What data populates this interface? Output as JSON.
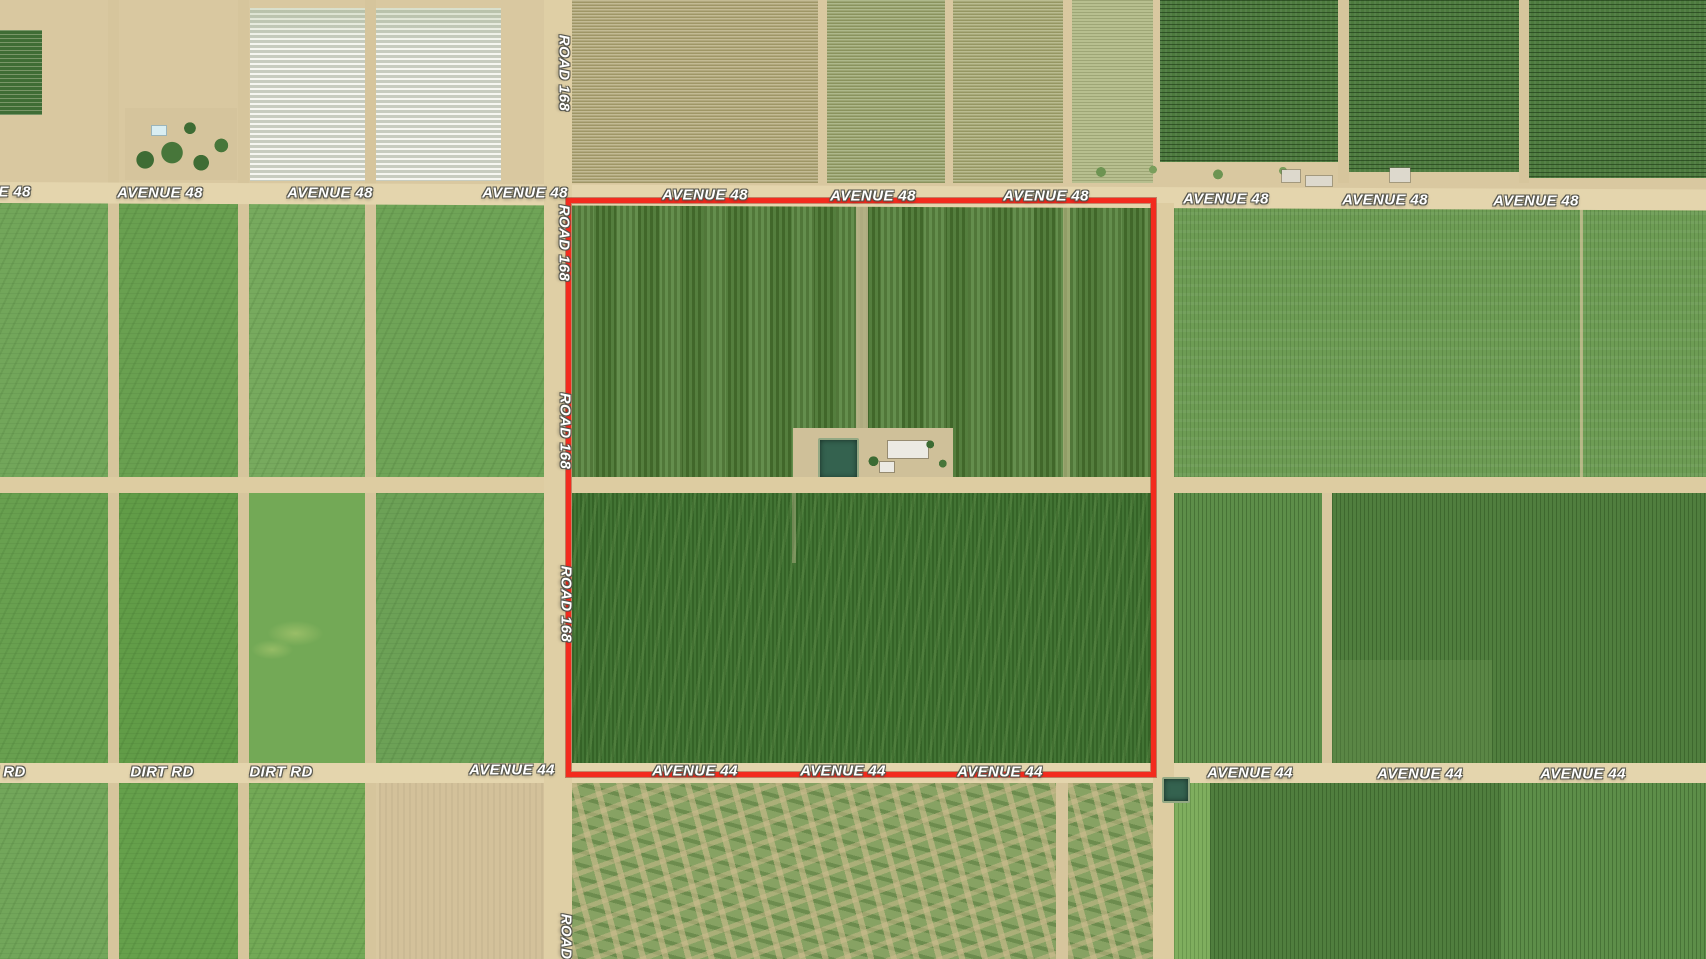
{
  "map": {
    "type": "aerial-satellite-parcel-map",
    "base_ground_color": "#d9c8a0",
    "road_color": "#ddcca1",
    "label_text_color": "#ffffff"
  },
  "boundary": {
    "x": 566,
    "y": 198,
    "w": 590,
    "h": 579,
    "color": "#f32b1e"
  },
  "road_labels": {
    "items": [
      {
        "text": "AVENUE 48",
        "x": -12,
        "y": 192
      },
      {
        "text": "AVENUE 48",
        "x": 160,
        "y": 193
      },
      {
        "text": "AVENUE 48",
        "x": 330,
        "y": 193
      },
      {
        "text": "AVENUE 48",
        "x": 525,
        "y": 193
      },
      {
        "text": "AVENUE 48",
        "x": 705,
        "y": 195
      },
      {
        "text": "AVENUE 48",
        "x": 873,
        "y": 196
      },
      {
        "text": "AVENUE 48",
        "x": 1046,
        "y": 196
      },
      {
        "text": "AVENUE 48",
        "x": 1226,
        "y": 199
      },
      {
        "text": "AVENUE 48",
        "x": 1385,
        "y": 200
      },
      {
        "text": "AVENUE 48",
        "x": 1536,
        "y": 201
      },
      {
        "text": "AVENUE 44",
        "x": 512,
        "y": 770
      },
      {
        "text": "AVENUE 44",
        "x": 695,
        "y": 771
      },
      {
        "text": "AVENUE 44",
        "x": 843,
        "y": 771
      },
      {
        "text": "AVENUE 44",
        "x": 1000,
        "y": 772
      },
      {
        "text": "AVENUE 44",
        "x": 1250,
        "y": 773
      },
      {
        "text": "AVENUE 44",
        "x": 1420,
        "y": 774
      },
      {
        "text": "AVENUE 44",
        "x": 1583,
        "y": 774
      },
      {
        "text": "DIRT RD",
        "x": -6,
        "y": 772
      },
      {
        "text": "DIRT RD",
        "x": 162,
        "y": 772
      },
      {
        "text": "DIRT RD",
        "x": 281,
        "y": 772
      },
      {
        "text": "ROAD 168",
        "x": 564,
        "y": 73,
        "vertical": true
      },
      {
        "text": "ROAD 168",
        "x": 564,
        "y": 243,
        "vertical": true
      },
      {
        "text": "ROAD 168",
        "x": 565,
        "y": 431,
        "vertical": true
      },
      {
        "text": "ROAD 168",
        "x": 566,
        "y": 604,
        "vertical": true
      },
      {
        "text": "ROAD 168",
        "x": 566,
        "y": 952,
        "vertical": true
      }
    ]
  }
}
